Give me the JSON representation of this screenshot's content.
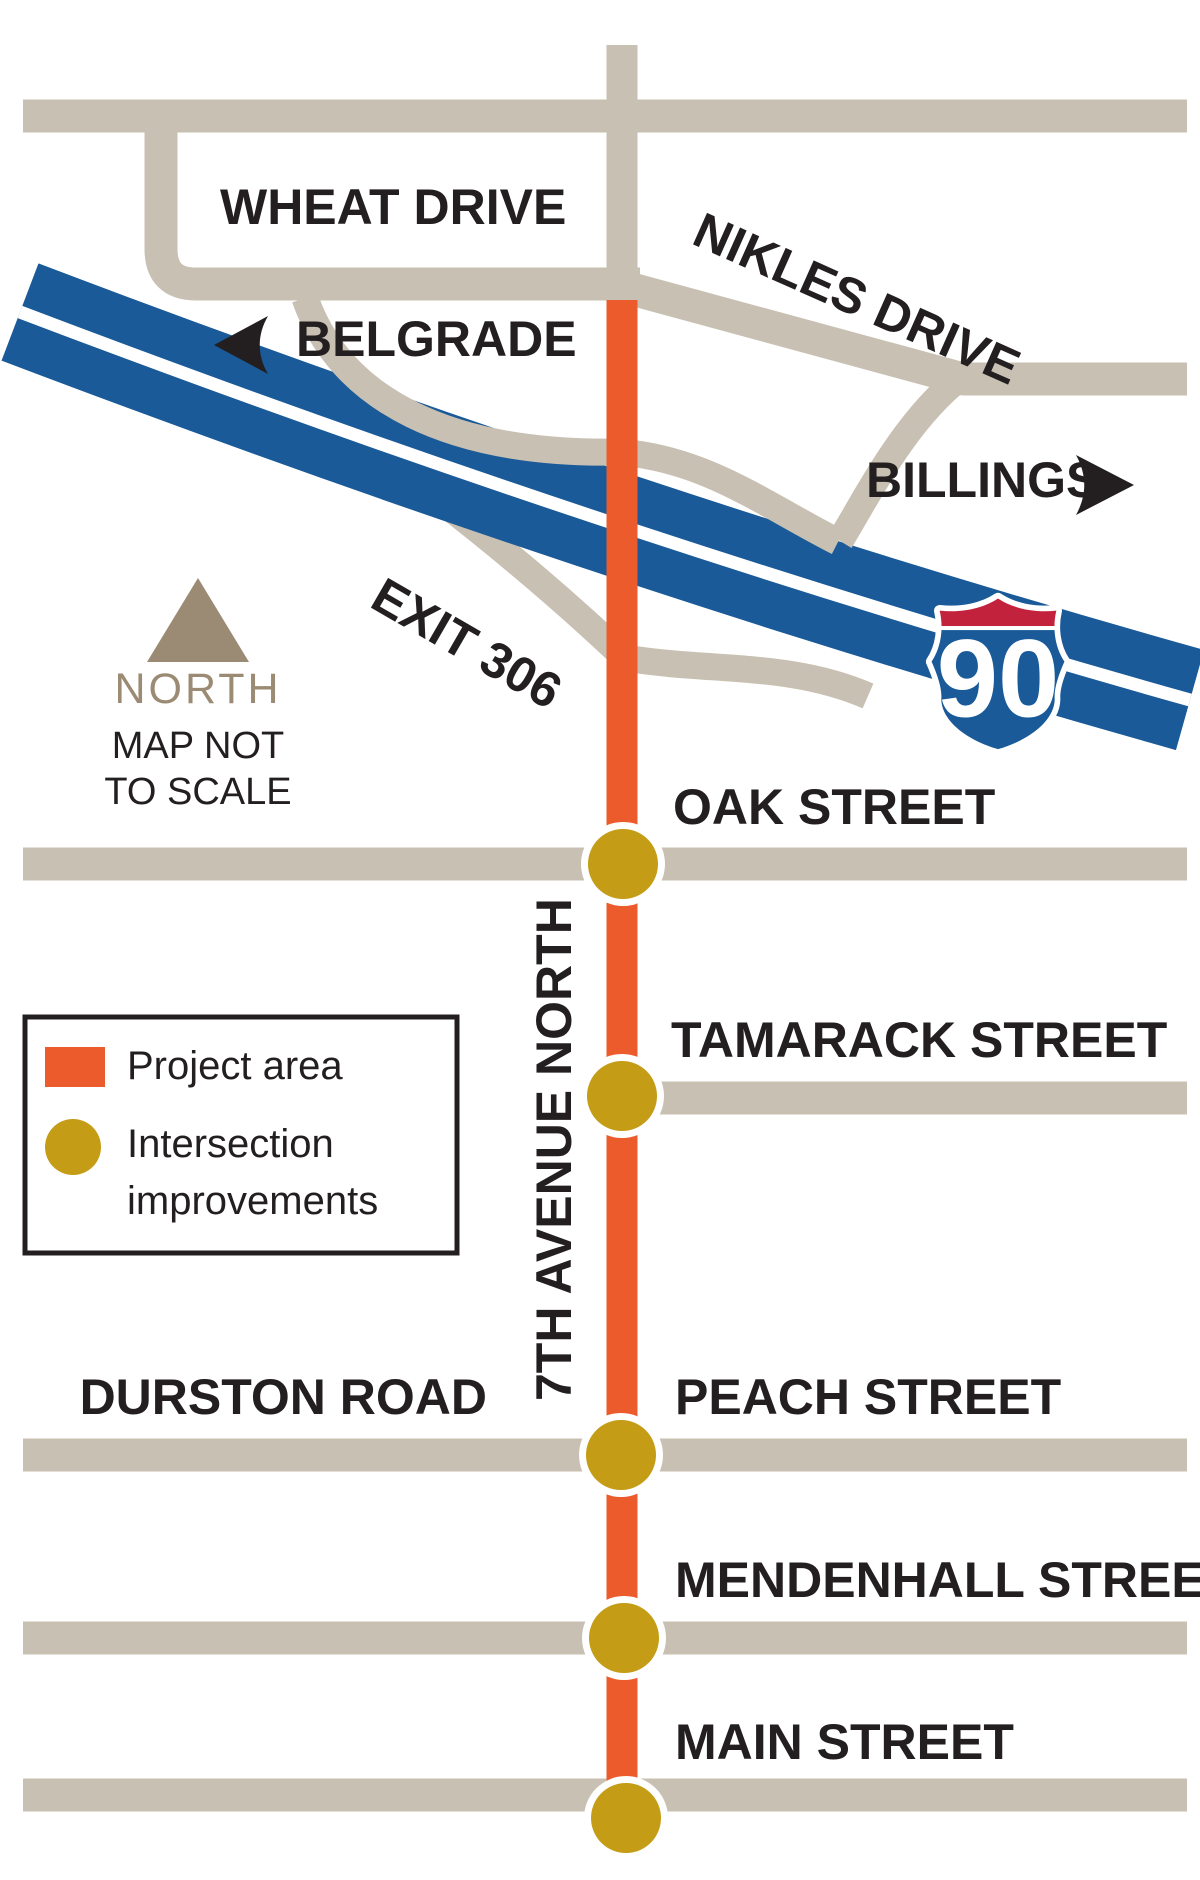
{
  "colors": {
    "paper": "#ffffff",
    "road": "#c8c0b2",
    "highway": "#1a5a98",
    "project": "#eb5b2b",
    "intersection": "#c49c16",
    "north": "#9c8b74",
    "ink": "#231f20",
    "shield-red": "#c3223c"
  },
  "labels": {
    "wheat_drive": "WHEAT DRIVE",
    "nikles_drive": "NIKLES DRIVE",
    "belgrade": "BELGRADE",
    "billings": "BILLINGS",
    "exit": "EXIT 306",
    "interstate_number": "90",
    "north": "NORTH",
    "scale_line1": "MAP NOT",
    "scale_line2": "TO SCALE",
    "seventh_avenue": "7TH AVENUE NORTH",
    "oak": "OAK STREET",
    "tamarack": "TAMARACK STREET",
    "durston": "DURSTON ROAD",
    "peach": "PEACH STREET",
    "mendenhall": "MENDENHALL STREET",
    "main": "MAIN STREET"
  },
  "legend": {
    "project_area": "Project area",
    "intersection_line1": "Intersection",
    "intersection_line2": "improvements"
  }
}
